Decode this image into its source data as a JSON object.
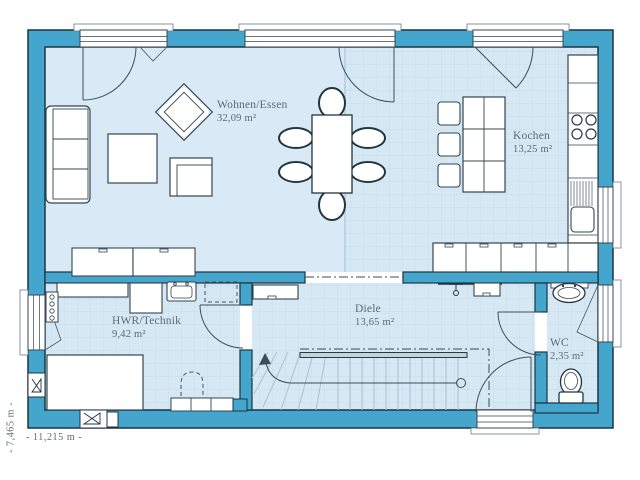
{
  "title": "Hanse Haus floor plan - ground floor",
  "rooms": {
    "wohnen": {
      "name": "Wohnen/Essen",
      "area": "32,09 m²"
    },
    "kochen": {
      "name": "Kochen",
      "area": "13,25 m²"
    },
    "hwr": {
      "name": "HWR/Technik",
      "area": "9,42 m²"
    },
    "diele": {
      "name": "Diele",
      "area": "13,65 m²"
    },
    "wc": {
      "name": "WC",
      "area": "2,35 m²"
    }
  },
  "dimensions": {
    "width": "- 11,215 m -",
    "height": "- 7,465 m -"
  },
  "colors": {
    "wall": "#45a6cd",
    "floor": "#d9eaf6",
    "tile_line": "#c6dcec",
    "outline": "#1d3440",
    "text": "#5b6b77"
  }
}
